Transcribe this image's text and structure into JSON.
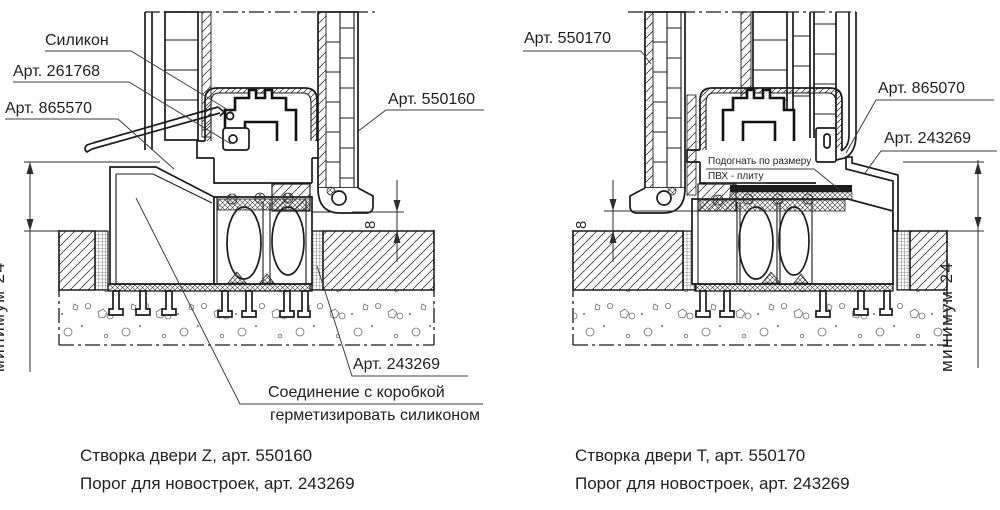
{
  "document_type": "technical section drawing, PVC door threshold details",
  "colors": {
    "background": "#ffffff",
    "line": "#1a1a1a",
    "leader": "#3c3c3c",
    "text": "#1f1f1f"
  },
  "drawing_left": {
    "labels": {
      "silicone": "Силикон",
      "art_261768": "Арт. 261768",
      "art_865570": "Арт. 865570",
      "art_550160": "Арт. 550160",
      "art_243269": "Арт. 243269",
      "joint_note_line1": "Соединение с коробкой",
      "joint_note_line2": "герметизировать силиконом",
      "dim_min": "минимум 24",
      "dim_gap": "8"
    },
    "caption_line1": "Створка двери Z, арт. 550160",
    "caption_line2": "Порог для новостроек, арт. 243269"
  },
  "drawing_right": {
    "labels": {
      "art_550170": "Арт. 550170",
      "art_865070": "Арт. 865070",
      "art_243269": "Арт. 243269",
      "fit_note_line1": "Подогнать по размеру",
      "fit_note_line2": "ПВХ - плиту",
      "dim_min": "минимум 24",
      "dim_gap": "8"
    },
    "caption_line1": "Створка двери Т, арт. 550170",
    "caption_line2": "Порог для новостроек, арт. 243269"
  }
}
